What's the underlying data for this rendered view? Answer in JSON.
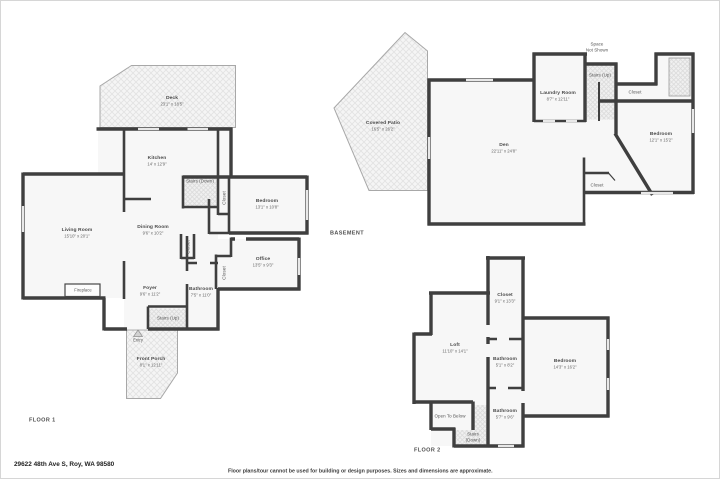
{
  "page": {
    "address": "29622 48th Ave S, Roy, WA 98580",
    "disclaimer": "Floor plans/tour cannot be used for building or design purposes. Sizes and dimensions are approximate."
  },
  "colors": {
    "wall": "#3f3f3f",
    "room_fill": "#f7f7f7",
    "hatch": "#e3e3e3",
    "window": "#e8e8e8"
  },
  "floor1": {
    "title": "FLOOR 1",
    "rooms": {
      "deck": {
        "name": "Deck",
        "dims": "23'1\" x 18'5\""
      },
      "kitchen": {
        "name": "Kitchen",
        "dims": "14' x 12'9\""
      },
      "stairs_down": {
        "name": "Stairs (Down)"
      },
      "closet_stairs": {
        "name": "Closet"
      },
      "bedroom": {
        "name": "Bedroom",
        "dims": "13'1\" x 10'8\""
      },
      "living_room": {
        "name": "Living Room",
        "dims": "15'10\" x 20'1\""
      },
      "dining_room": {
        "name": "Dining Room",
        "dims": "9'6\" x 10'2\""
      },
      "closet_dining": {
        "name": "Closet"
      },
      "office": {
        "name": "Office",
        "dims": "13'5\" x 9'3\""
      },
      "closet_office": {
        "name": "Closet"
      },
      "fireplace": {
        "name": "Fireplace"
      },
      "foyer": {
        "name": "Foyer",
        "dims": "9'6\" x 11'2\""
      },
      "bathroom": {
        "name": "Bathroom",
        "dims": "7'5\" x 11'0\""
      },
      "stairs_up": {
        "name": "Stairs (Up)"
      },
      "entry": {
        "name": "Entry"
      },
      "front_porch": {
        "name": "Front Porch",
        "dims": "8'1\" x 12'11\""
      }
    }
  },
  "basement": {
    "title": "BASEMENT",
    "rooms": {
      "space_not_shown": {
        "line1": "Space",
        "line2": "Not Shown"
      },
      "covered_patio": {
        "name": "Covered Patio",
        "dims": "16'5\" x 26'2\""
      },
      "den": {
        "name": "Den",
        "dims": "22'11\" x 24'8\""
      },
      "laundry": {
        "name": "Laundry Room",
        "dims": "8'7\" x 12'11\""
      },
      "stairs_up": {
        "name": "Stairs (Up)"
      },
      "closet_top": {
        "name": "Closet"
      },
      "bedroom": {
        "name": "Bedroom",
        "dims": "12'1\" x 15'2\""
      },
      "closet_den": {
        "name": "Closet"
      }
    }
  },
  "floor2": {
    "title": "FLOOR 2",
    "rooms": {
      "closet": {
        "name": "Closet",
        "dims": "9'1\" x 13'3\""
      },
      "loft": {
        "name": "Loft",
        "dims": "11'10\" x 14'1\""
      },
      "bathroom_mid": {
        "name": "Bathroom",
        "dims": "5'1\" x 8'2\""
      },
      "bedroom": {
        "name": "Bedroom",
        "dims": "14'3\" x 16'2\""
      },
      "open_to_below": {
        "name": "Open To Below"
      },
      "stairs_down": {
        "line1": "Stairs",
        "line2": "(Down)"
      },
      "bathroom_bottom": {
        "name": "Bathroom",
        "dims": "5'7\" x 9'6\""
      }
    }
  }
}
